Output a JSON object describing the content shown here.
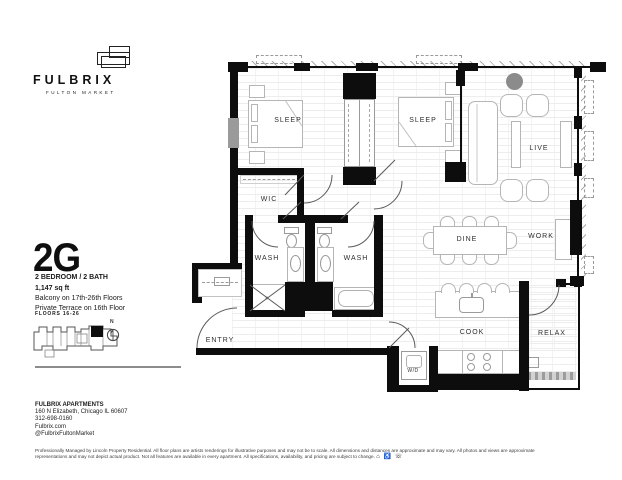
{
  "brand": {
    "name": "FULBRIX",
    "tagline": "FULTON MARKET"
  },
  "unit": {
    "code": "2G",
    "type": "2 BEDROOM / 2 BATH",
    "area": "1,147 sq ft",
    "feature1": "Balcony on 17th-26th Floors",
    "feature2": "Private Terrace on 16th Floor",
    "floors_label": "FLOORS 16-26",
    "compass_label": "N"
  },
  "floorplan": {
    "rooms": [
      {
        "id": "sleep-1",
        "label": "SLEEP"
      },
      {
        "id": "sleep-2",
        "label": "SLEEP"
      },
      {
        "id": "wic",
        "label": "WIC"
      },
      {
        "id": "wash-1",
        "label": "WASH"
      },
      {
        "id": "wash-2",
        "label": "WASH"
      },
      {
        "id": "live",
        "label": "LIVE"
      },
      {
        "id": "dine",
        "label": "DINE"
      },
      {
        "id": "work",
        "label": "WORK"
      },
      {
        "id": "cook",
        "label": "COOK"
      },
      {
        "id": "relax",
        "label": "RELAX"
      },
      {
        "id": "entry",
        "label": "ENTRY"
      },
      {
        "id": "wd",
        "label": "W/D"
      }
    ]
  },
  "contact": {
    "company": "FULBRIX APARTMENTS",
    "address": "160 N Elizabeth, Chicago IL 60607",
    "phone": "312-698-0160",
    "website": "Fulbrix.com",
    "social": "@FulbrixFultonMarket"
  },
  "legal": {
    "line1": "Professionally Managed by Lincoln Property Residential. All floor plans are artists renderings for illustrative purposes and may not be to scale. All dimensions and distances are approximate and may vary. All photos and views are approximate",
    "line2": "representations and may not depict actual product. Not all features are available in every apartment. All specifications, availability, and pricing are subject to change.",
    "icons": [
      {
        "name": "equal-housing-icon",
        "glyph": "⌂"
      },
      {
        "name": "accessibility-icon",
        "glyph": "♿"
      },
      {
        "name": "tty-icon",
        "glyph": "☏"
      }
    ]
  },
  "colors": {
    "wall": "#0d0d0d",
    "text": "#1a1a1a",
    "furniture_line": "#b5b5b5",
    "floor_line": "#ededed"
  }
}
